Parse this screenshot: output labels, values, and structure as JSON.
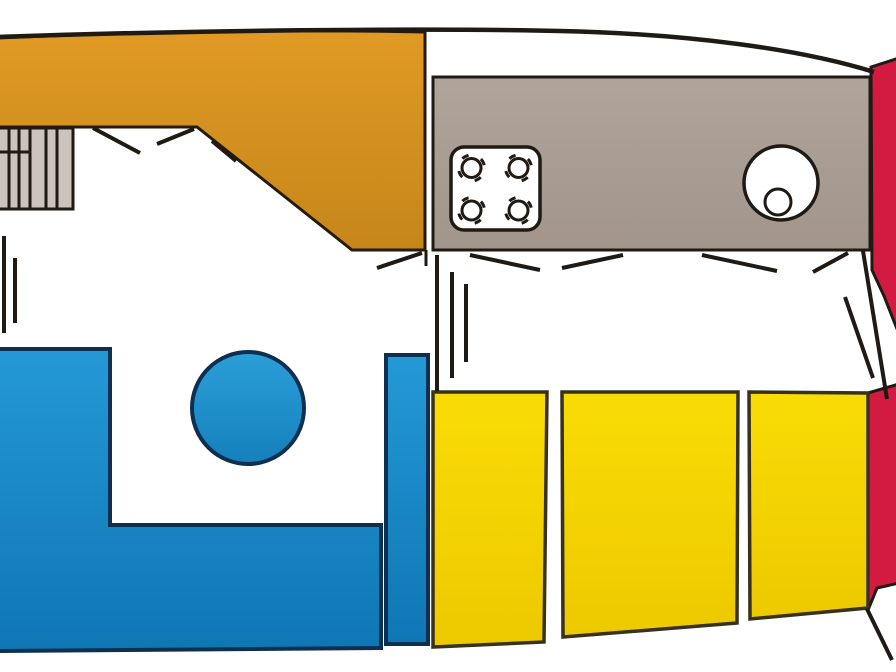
{
  "css_vars": {
    "--bg": "#ffffff",
    "--line": "#1f1a14",
    "--deck-border": "#241a0e",
    "--settee-border": "#0d3050",
    "--berth-border": "#37311e"
  },
  "floorplan": {
    "type": "boat-interior-deck-plan",
    "background": "#ffffff",
    "hull": {
      "outline_color": "#1f1a14"
    },
    "regions": {
      "foredeck": {
        "fill_top": "#e09a24",
        "fill_bottom": "#c6861a"
      },
      "companionway": {
        "fill": "#cbc3bc"
      },
      "galley": {
        "fill_top": "#b0a49b",
        "fill_bottom": "#a2958b"
      },
      "stove": {
        "fill": "#ffffff",
        "burner_count": 4
      },
      "sink": {
        "fill": "#ffffff"
      },
      "stern_upper": {
        "fill": "#d31a41"
      },
      "stern_lower": {
        "fill": "#d31a41"
      },
      "settee": {
        "fill_top": "#2499d6",
        "fill_bottom": "#0f76b4"
      },
      "table": {
        "fill_top": "#2b9fd8",
        "fill_bottom": "#1480bc"
      },
      "berths": {
        "fill_top": "#f9dc05",
        "fill_bottom": "#edc900",
        "count": 3
      }
    }
  }
}
